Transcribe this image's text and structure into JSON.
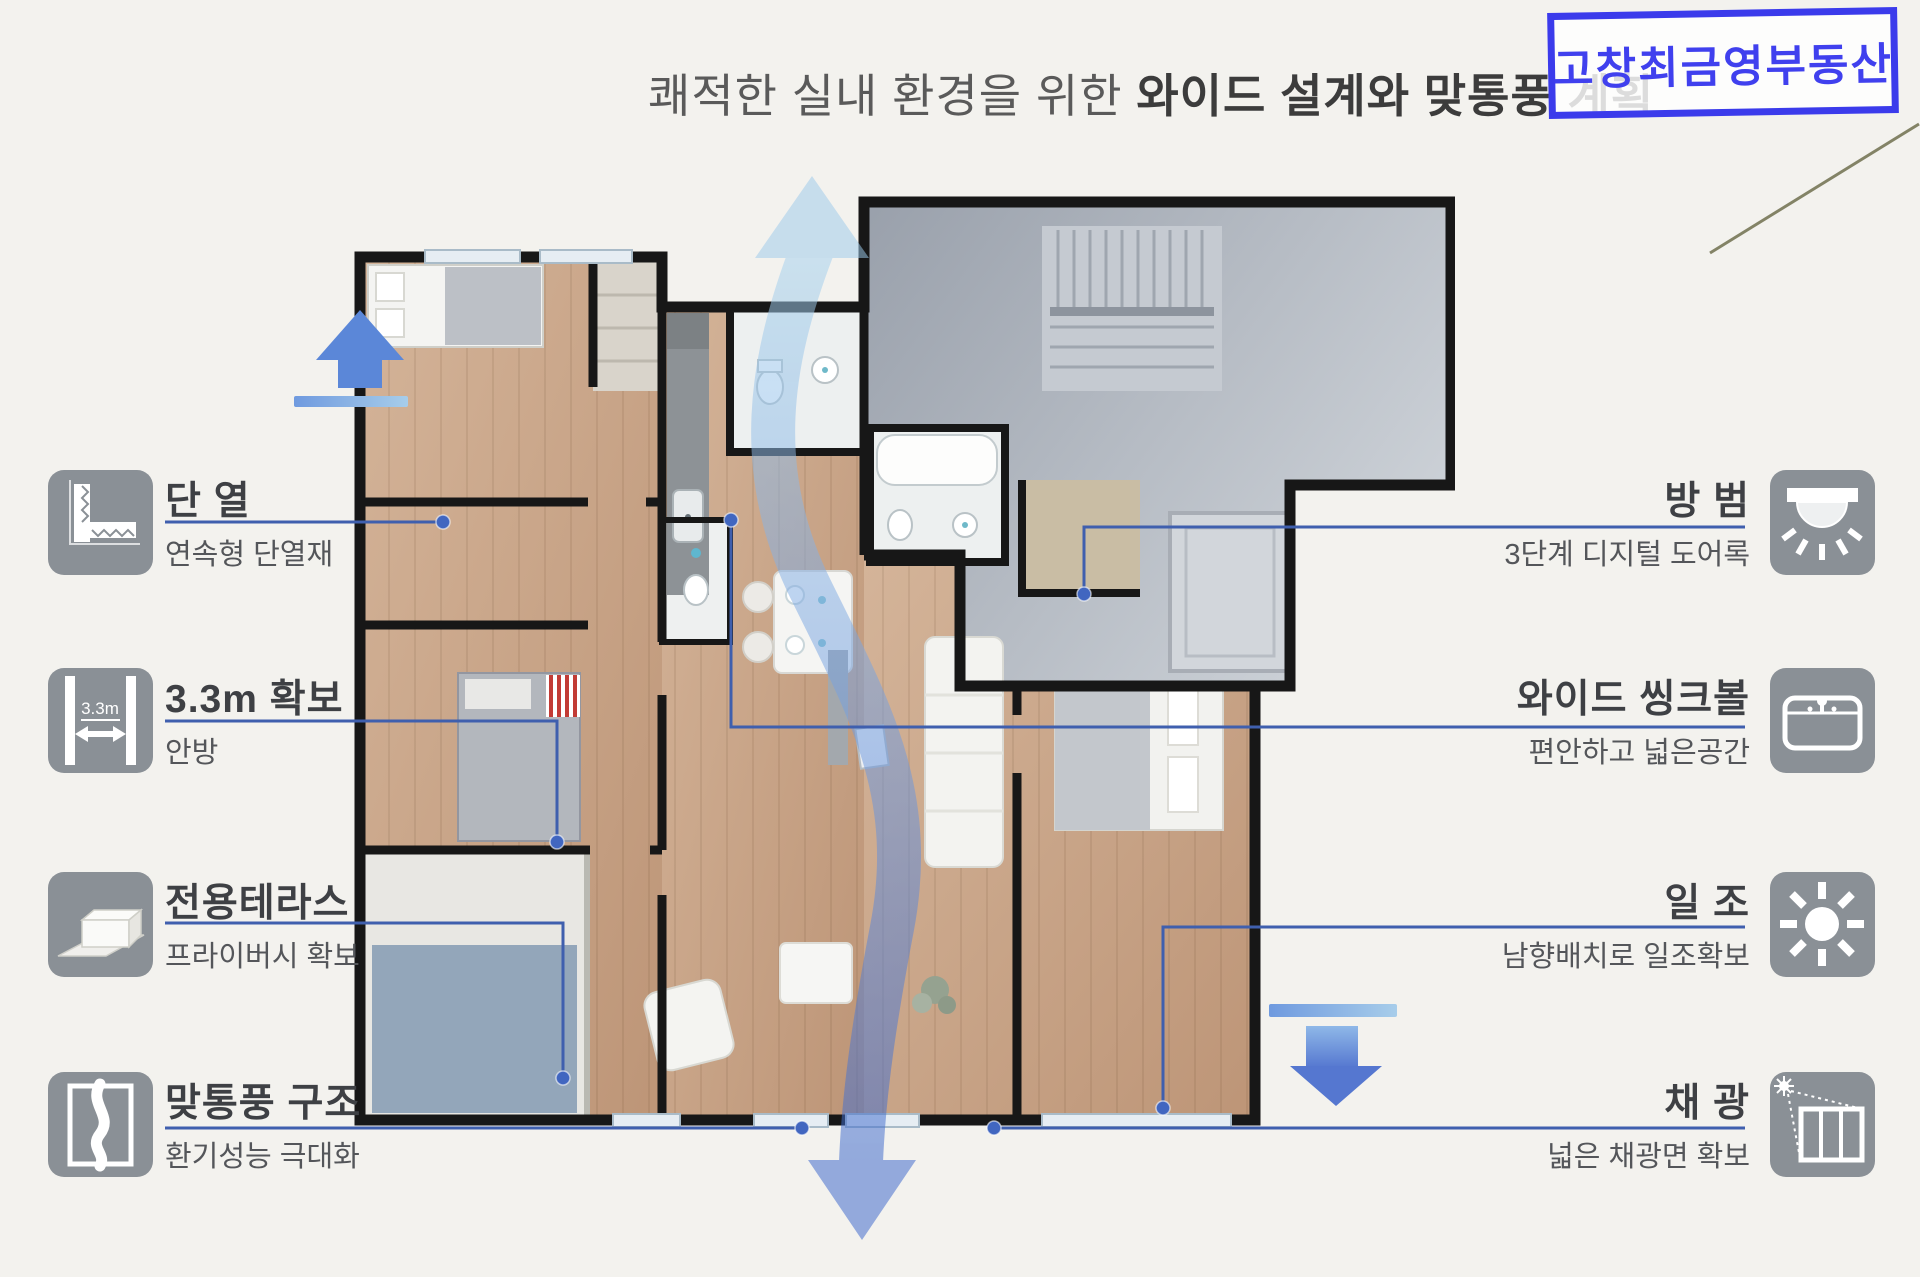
{
  "title": {
    "regular": "쾌적한 실내 환경을 위한 ",
    "bold": "와이드 설계와 맞통풍 계획"
  },
  "stamp": {
    "text": "고창최금영부동산"
  },
  "features_left": [
    {
      "title": "단 열",
      "subtitle": "연속형 단열재",
      "icon": "insulation-icon"
    },
    {
      "title": "3.3m 확보",
      "subtitle": "안방",
      "icon": "width-3-3m-icon",
      "icon_label": "3.3m"
    },
    {
      "title": "전용테라스",
      "subtitle": "프라이버시 확보",
      "icon": "terrace-icon"
    },
    {
      "title": "맞통풍 구조",
      "subtitle": "환기성능 극대화",
      "icon": "airflow-icon"
    }
  ],
  "features_right": [
    {
      "title": "방 범",
      "subtitle": "3단계 디지털 도어록",
      "icon": "security-lamp-icon"
    },
    {
      "title": "와이드 씽크볼",
      "subtitle": "편안하고 넓은공간",
      "icon": "sink-icon"
    },
    {
      "title": "일 조",
      "subtitle": "남향배치로 일조확보",
      "icon": "sun-icon"
    },
    {
      "title": "채 광",
      "subtitle": "넓은 채광면 확보",
      "icon": "daylight-window-icon"
    }
  ],
  "colors": {
    "accent_line": "#3f5fae",
    "dot": "#4166c0",
    "stamp_blue": "#3b3beb",
    "flow_top": "#a6d2ee",
    "flow_bottom": "#3c68cc",
    "wall": "#171717",
    "icon_bg": "#8a9096"
  }
}
